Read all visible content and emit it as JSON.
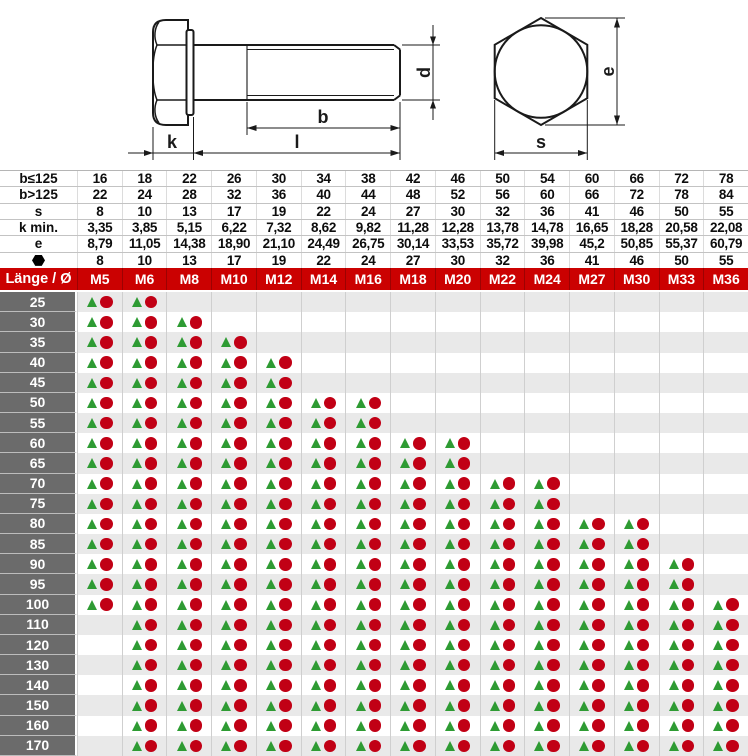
{
  "drawing": {
    "labels": {
      "head_height": "k",
      "thread_length": "b",
      "total_length": "l",
      "diameter": "d",
      "across_corners": "e",
      "across_flats": "s"
    }
  },
  "spec_table": {
    "rows": [
      {
        "label": "b≤125",
        "values": [
          "16",
          "18",
          "22",
          "26",
          "30",
          "34",
          "38",
          "42",
          "46",
          "50",
          "54",
          "60",
          "66",
          "72",
          "78"
        ]
      },
      {
        "label": "b>125",
        "values": [
          "22",
          "24",
          "28",
          "32",
          "36",
          "40",
          "44",
          "48",
          "52",
          "56",
          "60",
          "66",
          "72",
          "78",
          "84"
        ]
      },
      {
        "label": "s",
        "values": [
          "8",
          "10",
          "13",
          "17",
          "19",
          "22",
          "24",
          "27",
          "30",
          "32",
          "36",
          "41",
          "46",
          "50",
          "55"
        ]
      },
      {
        "label": "k min.",
        "values": [
          "3,35",
          "3,85",
          "5,15",
          "6,22",
          "7,32",
          "8,62",
          "9,82",
          "11,28",
          "12,28",
          "13,78",
          "14,78",
          "16,65",
          "18,28",
          "20,58",
          "22,08"
        ]
      },
      {
        "label": "e",
        "values": [
          "8,79",
          "11,05",
          "14,38",
          "18,90",
          "21,10",
          "24,49",
          "26,75",
          "30,14",
          "33,53",
          "35,72",
          "39,98",
          "45,2",
          "50,85",
          "55,37",
          "60,79"
        ]
      },
      {
        "label": "⬢",
        "symbol": "hexagon",
        "values": [
          "8",
          "10",
          "13",
          "17",
          "19",
          "22",
          "24",
          "27",
          "30",
          "32",
          "36",
          "41",
          "46",
          "50",
          "55"
        ]
      }
    ]
  },
  "main_table": {
    "corner_label": "Länge / Ø",
    "sizes": [
      "M5",
      "M6",
      "M8",
      "M10",
      "M12",
      "M14",
      "M16",
      "M18",
      "M20",
      "M22",
      "M24",
      "M27",
      "M30",
      "M33",
      "M36"
    ],
    "markers": {
      "triangle": "▲",
      "circle": "●"
    },
    "rows": [
      {
        "length": "25",
        "available": [
          1,
          1,
          0,
          0,
          0,
          0,
          0,
          0,
          0,
          0,
          0,
          0,
          0,
          0,
          0
        ]
      },
      {
        "length": "30",
        "available": [
          1,
          1,
          1,
          0,
          0,
          0,
          0,
          0,
          0,
          0,
          0,
          0,
          0,
          0,
          0
        ]
      },
      {
        "length": "35",
        "available": [
          1,
          1,
          1,
          1,
          0,
          0,
          0,
          0,
          0,
          0,
          0,
          0,
          0,
          0,
          0
        ]
      },
      {
        "length": "40",
        "available": [
          1,
          1,
          1,
          1,
          1,
          0,
          0,
          0,
          0,
          0,
          0,
          0,
          0,
          0,
          0
        ]
      },
      {
        "length": "45",
        "available": [
          1,
          1,
          1,
          1,
          1,
          0,
          0,
          0,
          0,
          0,
          0,
          0,
          0,
          0,
          0
        ]
      },
      {
        "length": "50",
        "available": [
          1,
          1,
          1,
          1,
          1,
          1,
          1,
          0,
          0,
          0,
          0,
          0,
          0,
          0,
          0
        ]
      },
      {
        "length": "55",
        "available": [
          1,
          1,
          1,
          1,
          1,
          1,
          1,
          0,
          0,
          0,
          0,
          0,
          0,
          0,
          0
        ]
      },
      {
        "length": "60",
        "available": [
          1,
          1,
          1,
          1,
          1,
          1,
          1,
          1,
          1,
          0,
          0,
          0,
          0,
          0,
          0
        ]
      },
      {
        "length": "65",
        "available": [
          1,
          1,
          1,
          1,
          1,
          1,
          1,
          1,
          1,
          0,
          0,
          0,
          0,
          0,
          0
        ]
      },
      {
        "length": "70",
        "available": [
          1,
          1,
          1,
          1,
          1,
          1,
          1,
          1,
          1,
          1,
          1,
          0,
          0,
          0,
          0
        ]
      },
      {
        "length": "75",
        "available": [
          1,
          1,
          1,
          1,
          1,
          1,
          1,
          1,
          1,
          1,
          1,
          0,
          0,
          0,
          0
        ]
      },
      {
        "length": "80",
        "available": [
          1,
          1,
          1,
          1,
          1,
          1,
          1,
          1,
          1,
          1,
          1,
          1,
          1,
          0,
          0
        ]
      },
      {
        "length": "85",
        "available": [
          1,
          1,
          1,
          1,
          1,
          1,
          1,
          1,
          1,
          1,
          1,
          1,
          1,
          0,
          0
        ]
      },
      {
        "length": "90",
        "available": [
          1,
          1,
          1,
          1,
          1,
          1,
          1,
          1,
          1,
          1,
          1,
          1,
          1,
          1,
          0
        ]
      },
      {
        "length": "95",
        "available": [
          1,
          1,
          1,
          1,
          1,
          1,
          1,
          1,
          1,
          1,
          1,
          1,
          1,
          1,
          0
        ]
      },
      {
        "length": "100",
        "available": [
          1,
          1,
          1,
          1,
          1,
          1,
          1,
          1,
          1,
          1,
          1,
          1,
          1,
          1,
          1
        ]
      },
      {
        "length": "110",
        "available": [
          0,
          1,
          1,
          1,
          1,
          1,
          1,
          1,
          1,
          1,
          1,
          1,
          1,
          1,
          1
        ]
      },
      {
        "length": "120",
        "available": [
          0,
          1,
          1,
          1,
          1,
          1,
          1,
          1,
          1,
          1,
          1,
          1,
          1,
          1,
          1
        ]
      },
      {
        "length": "130",
        "available": [
          0,
          1,
          1,
          1,
          1,
          1,
          1,
          1,
          1,
          1,
          1,
          1,
          1,
          1,
          1
        ]
      },
      {
        "length": "140",
        "available": [
          0,
          1,
          1,
          1,
          1,
          1,
          1,
          1,
          1,
          1,
          1,
          1,
          1,
          1,
          1
        ]
      },
      {
        "length": "150",
        "available": [
          0,
          1,
          1,
          1,
          1,
          1,
          1,
          1,
          1,
          1,
          1,
          1,
          1,
          1,
          1
        ]
      },
      {
        "length": "160",
        "available": [
          0,
          1,
          1,
          1,
          1,
          1,
          1,
          1,
          1,
          1,
          1,
          1,
          1,
          1,
          1
        ]
      },
      {
        "length": "170",
        "available": [
          0,
          1,
          1,
          1,
          1,
          1,
          1,
          1,
          1,
          1,
          1,
          1,
          1,
          1,
          1
        ]
      }
    ]
  },
  "colors": {
    "header_red": "#cb0101",
    "row_label_gray": "#6b6b6b",
    "row_alt_gray": "#e9e9e9",
    "triangle_green": "#2e9b33",
    "circle_red": "#c10015",
    "drawing_line": "#1a1a1a"
  }
}
